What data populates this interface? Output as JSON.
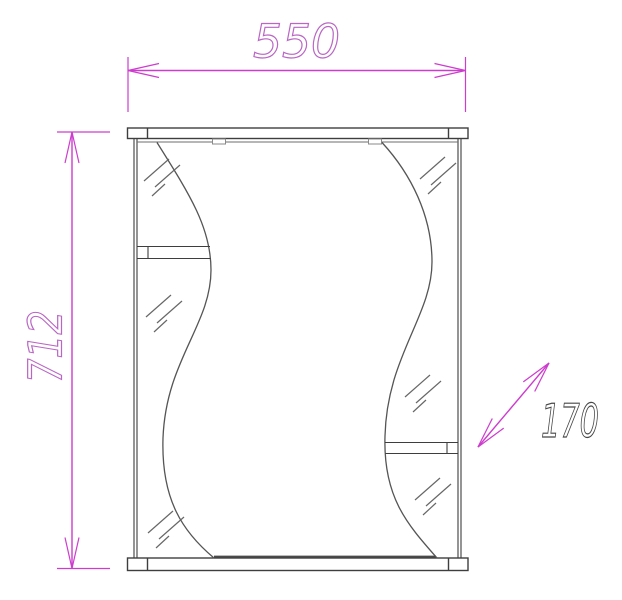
{
  "drawing": {
    "subject": "mirror-cabinet-front-view",
    "view": "technical-dimensional-drawing",
    "colors": {
      "outline": "#3e3e3e",
      "thin": "#6a6a6a",
      "hatch": "#676767",
      "dimension": "#cd3ccd",
      "dimension_text": "#b966c4",
      "depth_text": "#474747",
      "background": "#ffffff"
    },
    "dimensions": {
      "width_mm": "550",
      "height_mm": "712",
      "depth_mm": "170"
    }
  }
}
